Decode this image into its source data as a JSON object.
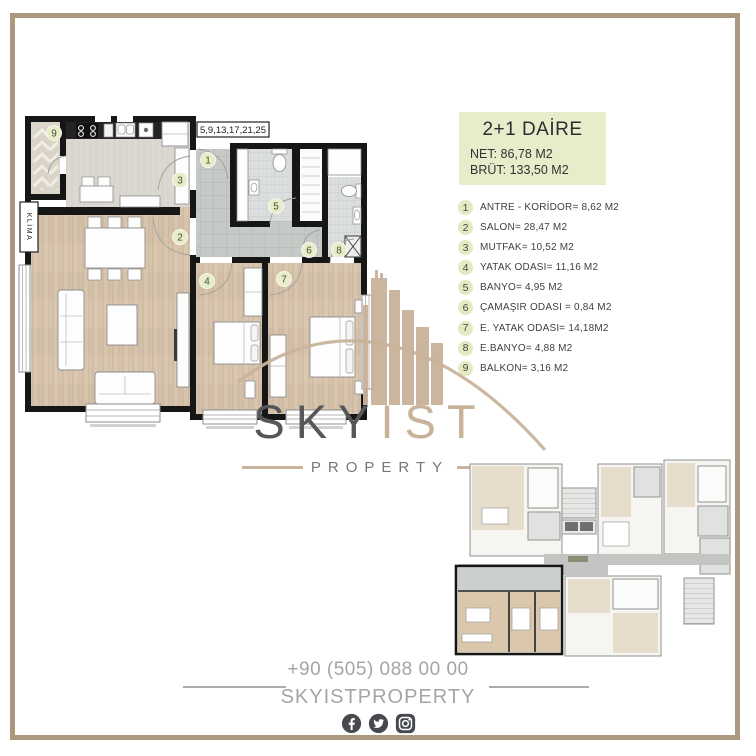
{
  "unit": {
    "title": "2+1 DAİRE",
    "net": "NET: 86,78 M2",
    "brut": "BRÜT: 133,50 M2"
  },
  "plan": {
    "floors_label": "5,9,13,17,21,25",
    "klima": "KLİMA"
  },
  "rooms": [
    {
      "num": "1",
      "label": "ANTRE - KORİDOR= 8,62 M2"
    },
    {
      "num": "2",
      "label": "SALON= 28,47 M2"
    },
    {
      "num": "3",
      "label": "MUTFAK= 10,52 M2"
    },
    {
      "num": "4",
      "label": "YATAK ODASI= 11,16 M2"
    },
    {
      "num": "5",
      "label": "BANYO= 4,95 M2"
    },
    {
      "num": "6",
      "label": "ÇAMAŞIR ODASI = 0,84 M2"
    },
    {
      "num": "7",
      "label": "E. YATAK ODASI= 14,18M2"
    },
    {
      "num": "8",
      "label": "E.BANYO= 4,88 M2"
    },
    {
      "num": "9",
      "label": "BALKON= 3,16 M2"
    }
  ],
  "watermark": {
    "primary": "SKY",
    "secondary": "IST",
    "subtitle": "PROPERTY"
  },
  "footer": {
    "phone": "+90 (505) 088 00 00",
    "handle": "SKYISTPROPERTY",
    "social": [
      "facebook-icon",
      "twitter-icon",
      "instagram-icon"
    ]
  },
  "colors": {
    "frame": "#ab997d",
    "accent_box": "#e9ecca",
    "marker": "#e3eac1",
    "watermark_tan": "#c8b299",
    "watermark_gray": "#55575a",
    "footer_gray": "#a3a5a7",
    "wall": "#161616",
    "wood": "#d7c4ac"
  }
}
